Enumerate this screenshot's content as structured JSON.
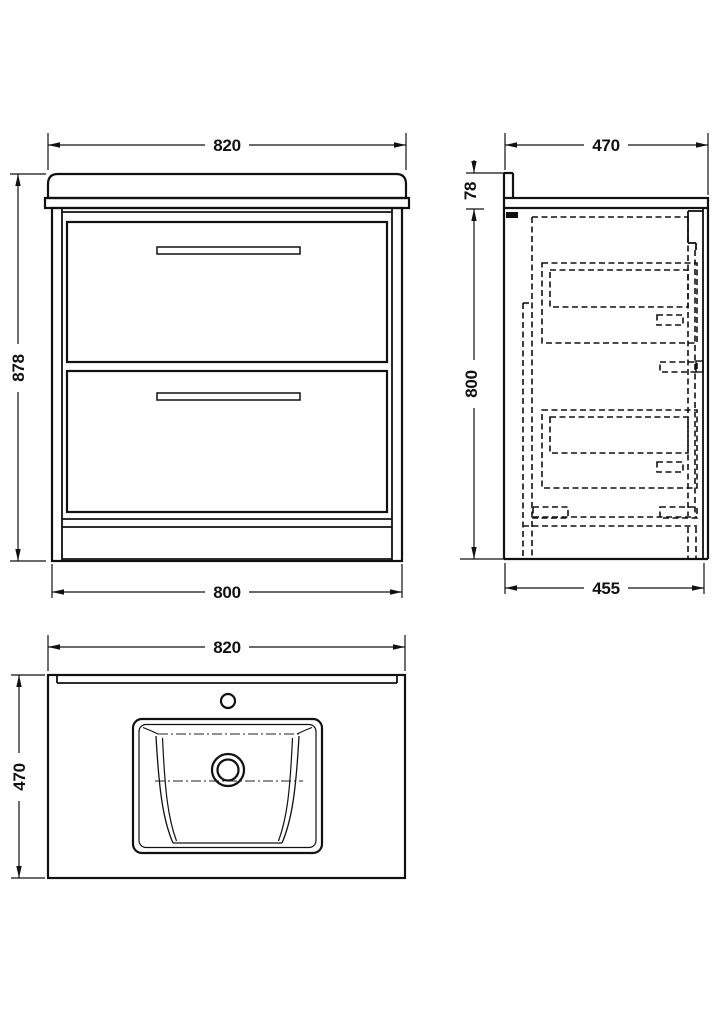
{
  "views": {
    "front": {
      "width_top": "820",
      "height": "878",
      "width_bottom": "800"
    },
    "side": {
      "depth_top": "470",
      "upstand_height": "78",
      "height": "800",
      "depth_bottom": "455"
    },
    "plan": {
      "width": "820",
      "depth": "470"
    }
  },
  "colors": {
    "line": "#111111",
    "background": "#ffffff"
  }
}
